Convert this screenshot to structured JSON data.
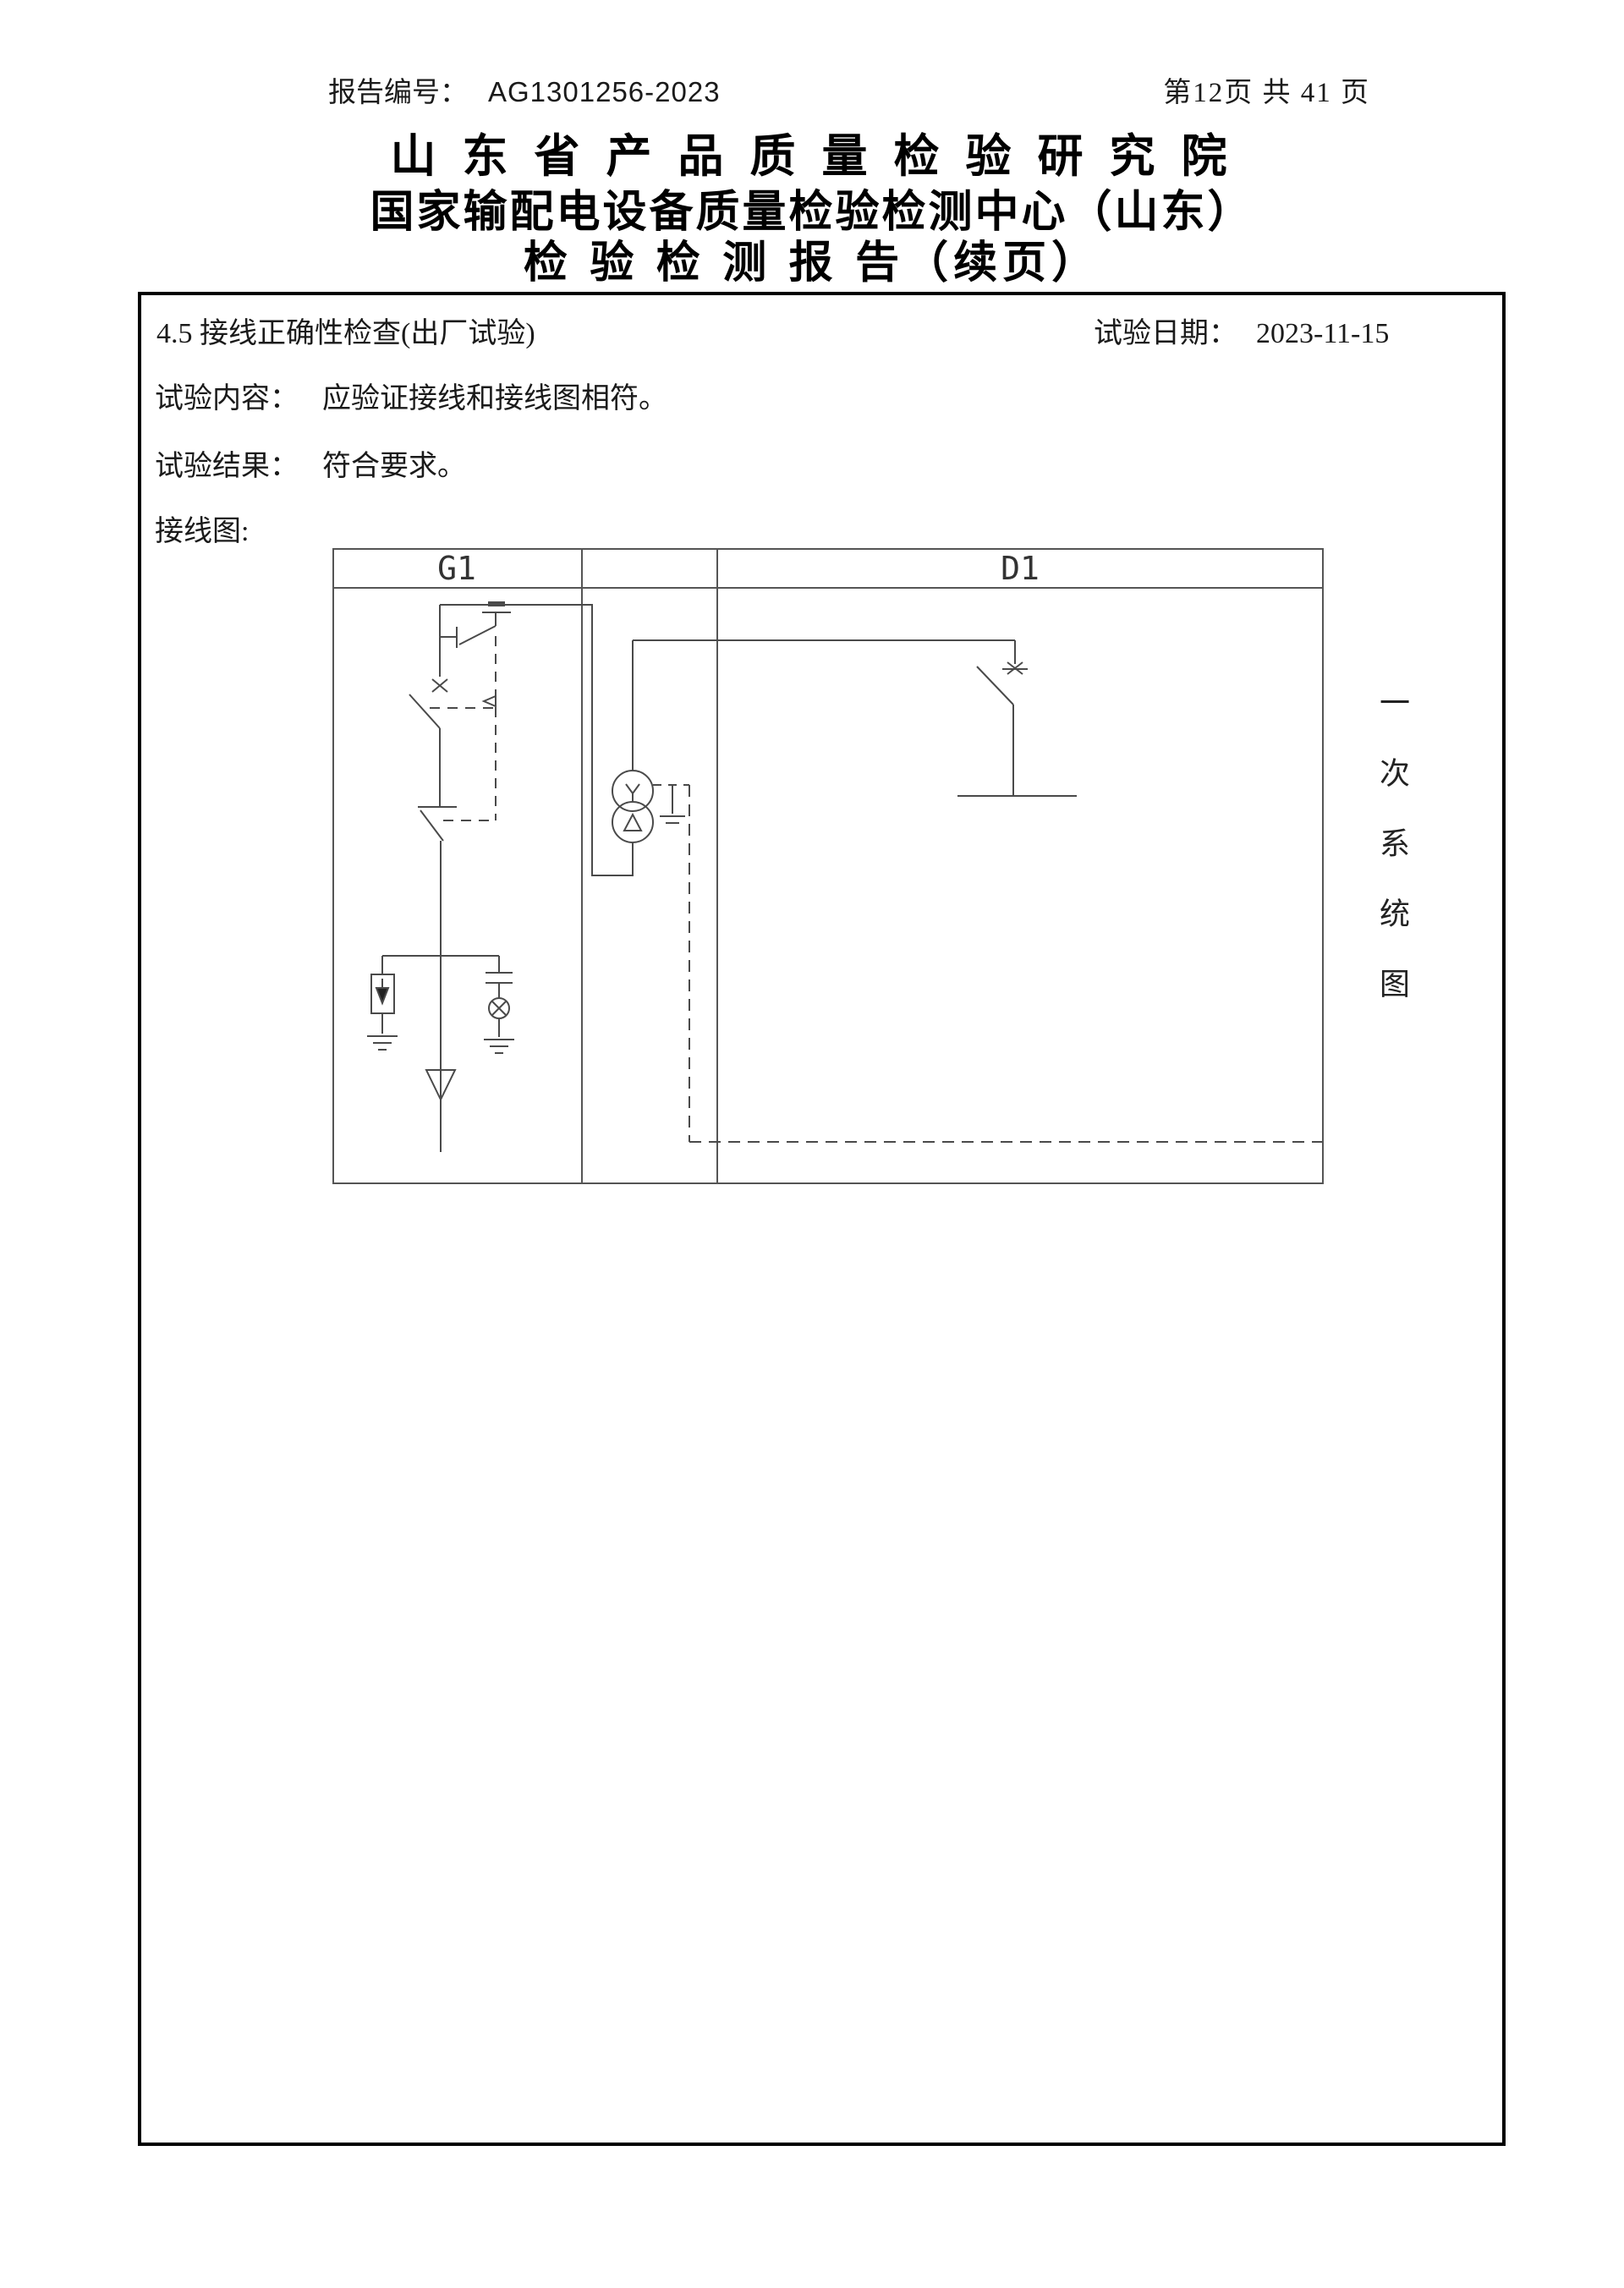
{
  "page_header": {
    "report_no_label": "报告编号：",
    "report_no": "AG1301256-2023",
    "page_info": "第12页  共 41 页"
  },
  "title": {
    "line1": "山 东 省 产 品 质 量 检 验 研 究 院",
    "line2": "国家输配电设备质量检验检测中心（山东）",
    "line3": "检 验 检 测 报 告（续页）"
  },
  "section": {
    "heading": "4.5 接线正确性检查(出厂试验)",
    "test_date_label": "试验日期：",
    "test_date": "2023-11-15",
    "content_label": "试验内容：",
    "content_text": "应验证接线和接线图相符。",
    "result_label": "试验结果：",
    "result_text": "符合要求。",
    "diagram_label": "接线图:"
  },
  "diagram": {
    "panel1_label": "G1",
    "panel2_label": "D1",
    "side_label": "一次系统图",
    "line_color": "#4a4a4a",
    "frame_color": "#555555"
  }
}
